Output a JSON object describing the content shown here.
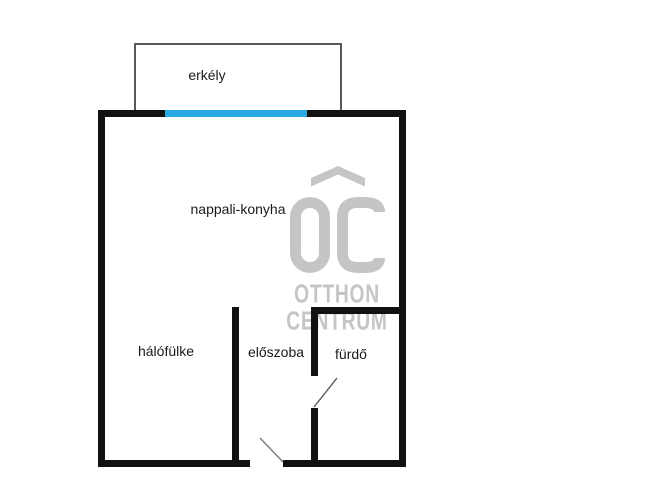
{
  "floorplan": {
    "type": "apartment-floor-plan",
    "rooms": [
      {
        "id": "balcony",
        "label": "erkély"
      },
      {
        "id": "living-kitchen",
        "label": "nappali-konyha"
      },
      {
        "id": "sleeping-alcove",
        "label": "hálófülke"
      },
      {
        "id": "hallway",
        "label": "előszoba"
      },
      {
        "id": "bathroom",
        "label": "fürdő"
      }
    ],
    "features": {
      "balcony_window_marker": "blue window/door strip on top wall",
      "entry_door": "opening in bottom wall with swing line",
      "bathroom_door": "opening in hallway/bathroom wall with swing line"
    },
    "colors": {
      "wall": "#111111",
      "window": "#29a9e1",
      "balcony_border": "#58595b",
      "label": "#1a1a1a",
      "watermark": "#c5c5c5",
      "door_line": "#7a7a7a"
    }
  },
  "watermark": {
    "monogram": "OC",
    "line1": "OTTHON",
    "line2": "CENTRUM"
  }
}
